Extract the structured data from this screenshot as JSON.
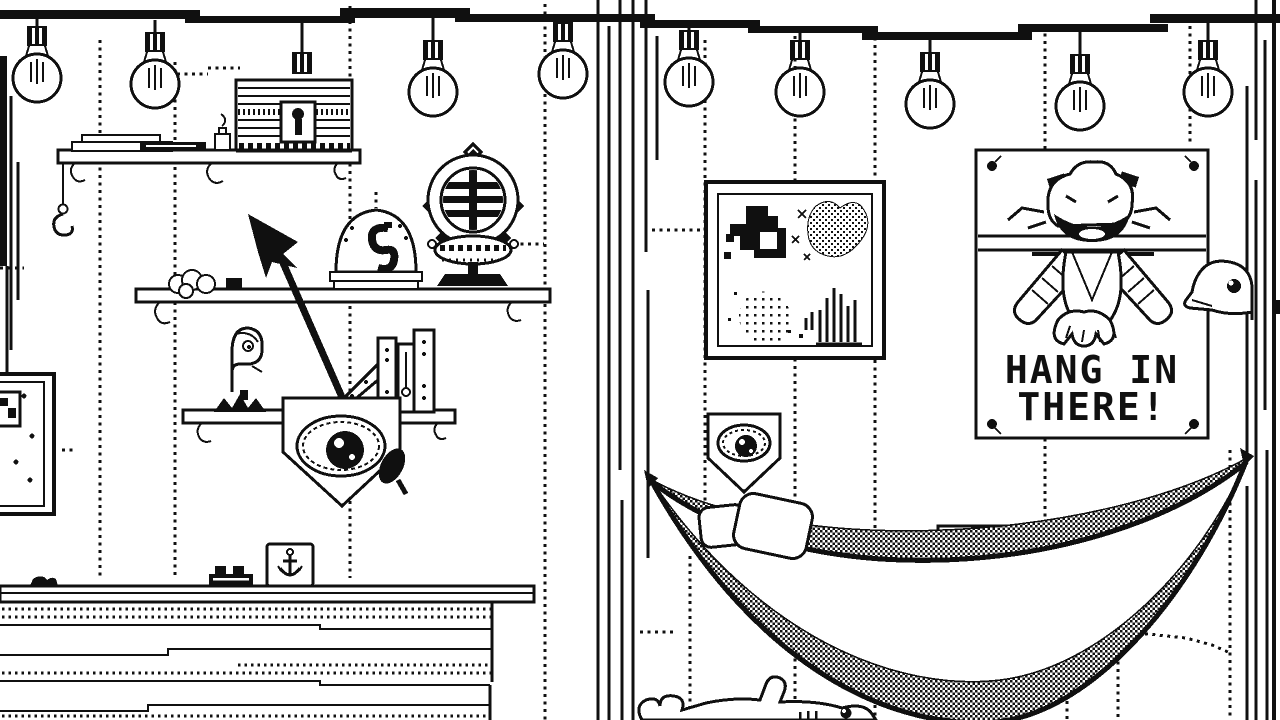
{
  "meta": {
    "style": "1-bit black-and-white pixel-art room scene",
    "ink_color": "#101010",
    "paper_color": "#ffffff",
    "rooms": 2,
    "light_bulb_count": 10
  },
  "poster": {
    "line1": "HANG IN",
    "line2": "THERE!"
  },
  "scene": {
    "left_room_objects": [
      "string-lights",
      "wall-shelf",
      "paper-stack",
      "oil-lamp",
      "treasure-chest",
      "string-hook",
      "rope-coil",
      "hook-bell-jar",
      "diving-helmet",
      "harpoon-arrow",
      "bird-statuette",
      "set-square",
      "books",
      "eye-shield-large",
      "wall-frame-partial",
      "sideboard",
      "rope-lump",
      "studded-box",
      "anchor-card"
    ],
    "right_room_objects": [
      "string-lights",
      "pixel-art-frame",
      "eye-shield-small",
      "motivational-poster",
      "duck-head",
      "hammock",
      "pillow",
      "pet-fish"
    ]
  }
}
